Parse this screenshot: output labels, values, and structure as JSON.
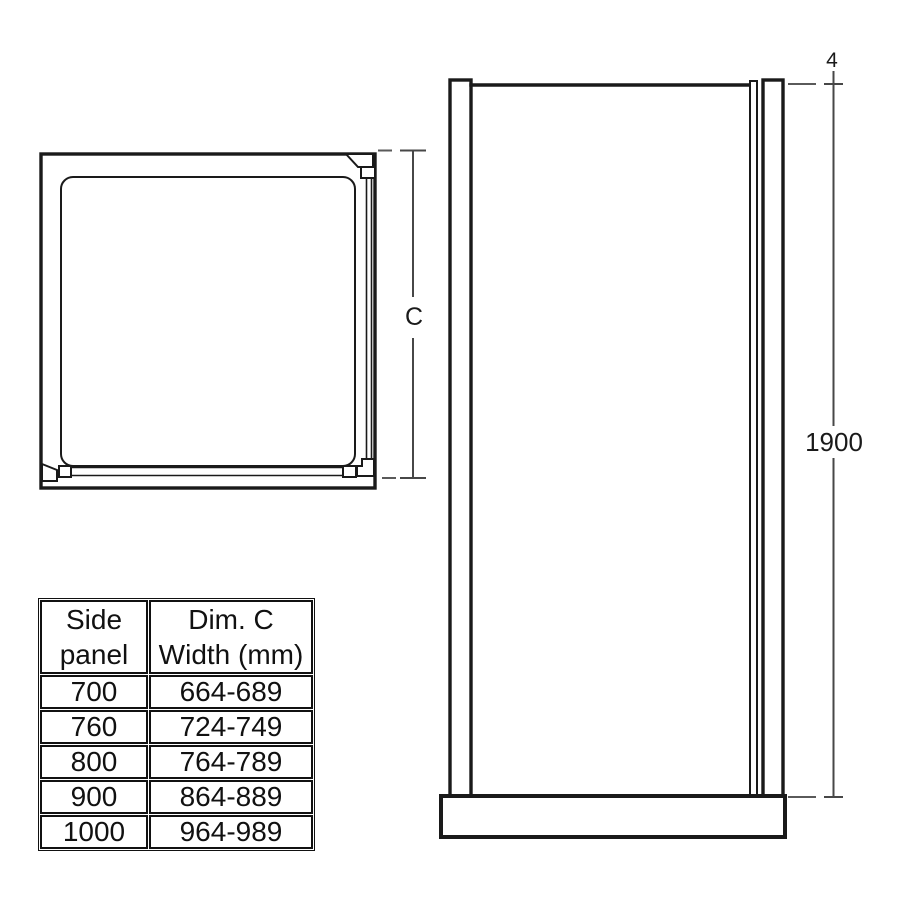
{
  "drawing": {
    "plan_view": {
      "dim_c_label": "C"
    },
    "elevation_view": {
      "top_offset_label": "4",
      "height_label": "1900"
    }
  },
  "size_table": {
    "col1_header": [
      "Side",
      "panel"
    ],
    "col2_header": [
      "Dim. C",
      "Width (mm)"
    ],
    "rows": [
      {
        "side_panel": "700",
        "dim_c": "664-689"
      },
      {
        "side_panel": "760",
        "dim_c": "724-749"
      },
      {
        "side_panel": "800",
        "dim_c": "764-789"
      },
      {
        "side_panel": "900",
        "dim_c": "864-889"
      },
      {
        "side_panel": "1000",
        "dim_c": "964-989"
      }
    ]
  },
  "colors": {
    "background": "#ffffff",
    "line": "#1a1a1a",
    "dimension_line": "#474747",
    "dash_line": "#5a5a5a",
    "text": "#111111"
  }
}
